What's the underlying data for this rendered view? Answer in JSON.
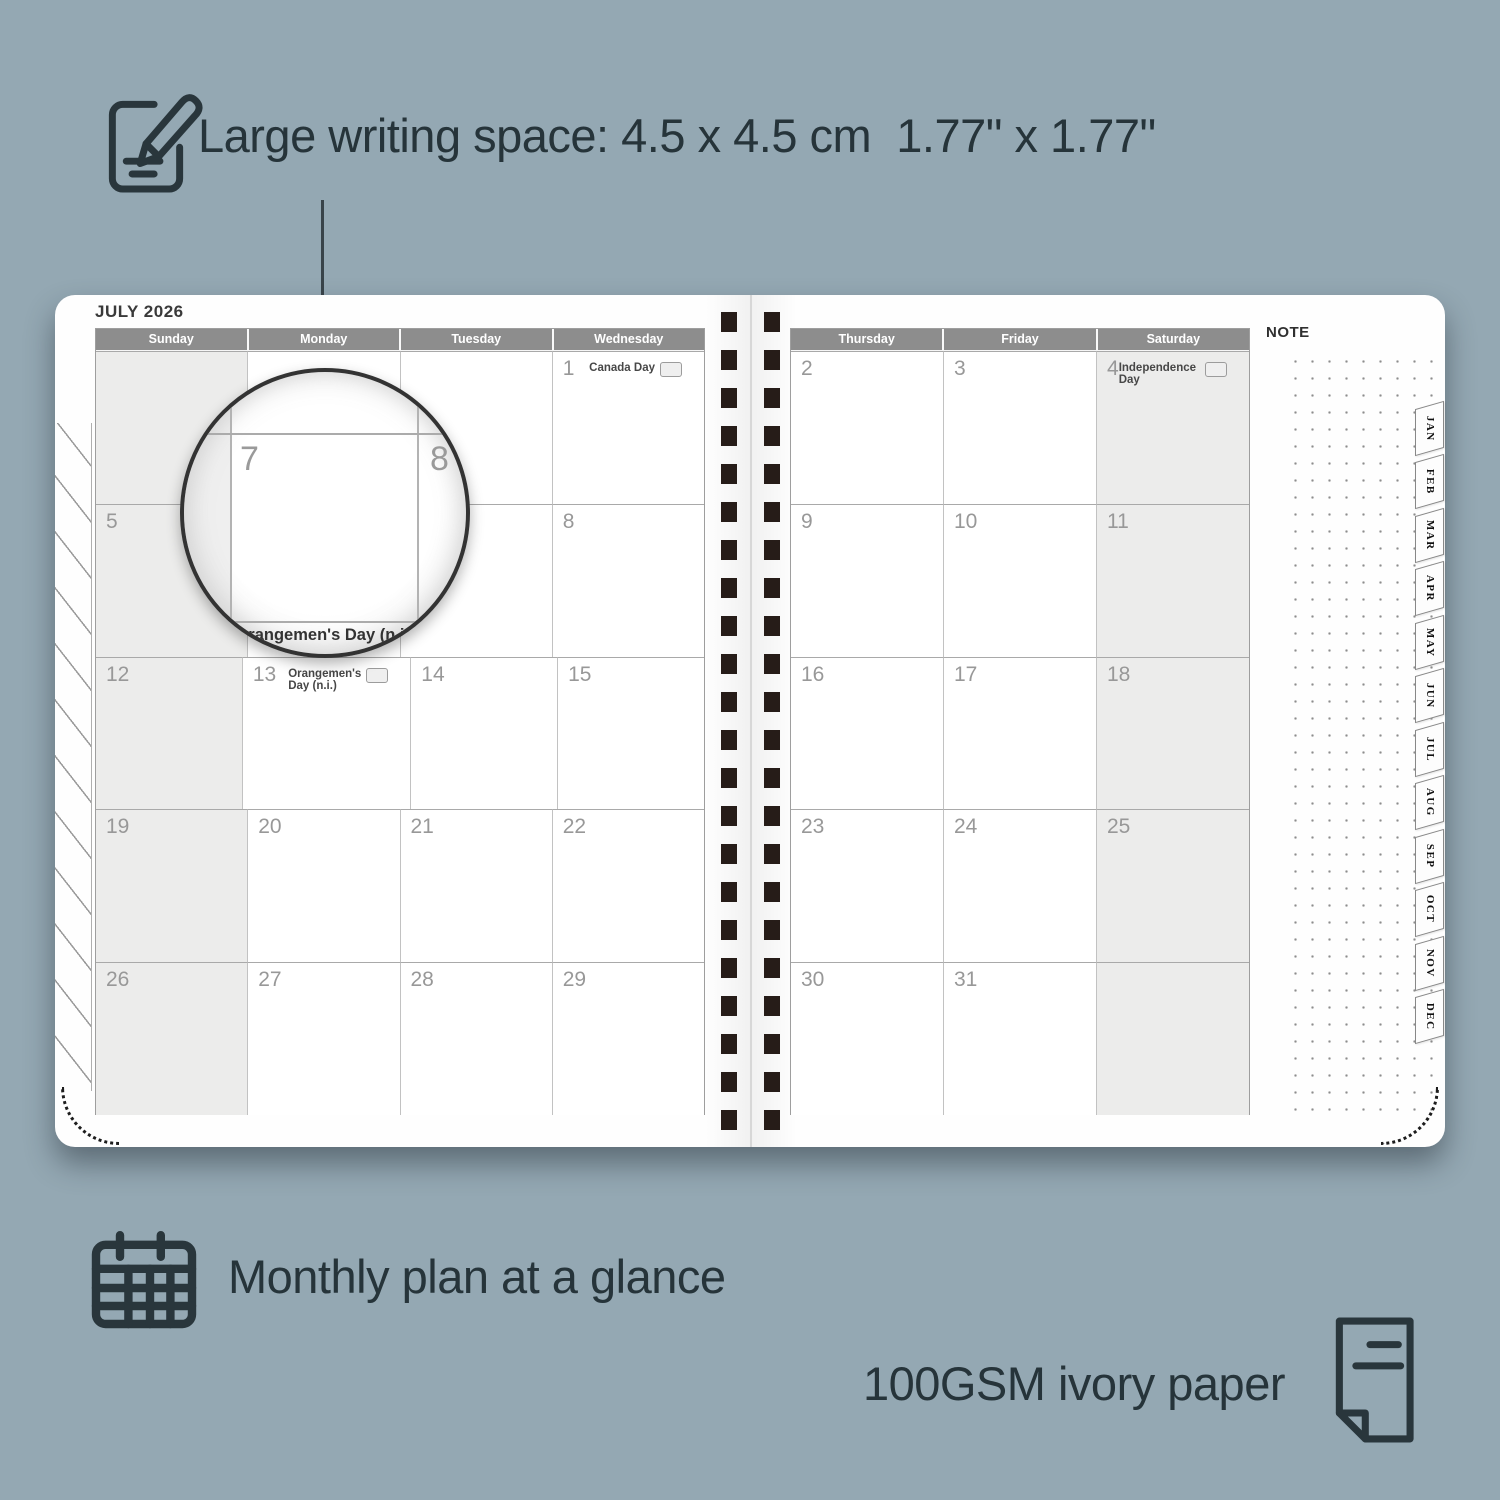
{
  "colors": {
    "background": "#94a8b3",
    "header_gray": "#8d8d8d",
    "shaded_cell": "#ececeb",
    "binding_dark": "#261c18",
    "accent_text": "#26343a"
  },
  "features": {
    "writing_space": {
      "label": "Large writing space: 4.5 x 4.5 cm  1.77\" x 1.77\""
    },
    "monthly": {
      "label": "Monthly plan at a glance"
    },
    "paper": {
      "label": "100GSM ivory paper"
    }
  },
  "planner": {
    "month_title": "JULY 2026",
    "note_label": "NOTE",
    "left_calendar": {
      "headers": [
        "Sunday",
        "Monday",
        "Tuesday",
        "Wednesday"
      ],
      "rows": [
        [
          {
            "day": ""
          },
          {
            "day": ""
          },
          {
            "day": ""
          },
          {
            "day": "1",
            "holiday": "Canada Day"
          }
        ],
        [
          {
            "day": "5"
          },
          {
            "day": "6"
          },
          {
            "day": "7"
          },
          {
            "day": "8"
          }
        ],
        [
          {
            "day": "12"
          },
          {
            "day": "13",
            "holiday": "Orangemen's Day (n.i.)"
          },
          {
            "day": "14"
          },
          {
            "day": "15"
          }
        ],
        [
          {
            "day": "19"
          },
          {
            "day": "20"
          },
          {
            "day": "21"
          },
          {
            "day": "22"
          }
        ],
        [
          {
            "day": "26"
          },
          {
            "day": "27"
          },
          {
            "day": "28"
          },
          {
            "day": "29"
          }
        ]
      ]
    },
    "right_calendar": {
      "headers": [
        "Thursday",
        "Friday",
        "Saturday"
      ],
      "rows": [
        [
          {
            "day": "2"
          },
          {
            "day": "3"
          },
          {
            "day": "4",
            "holiday": "Independence Day"
          }
        ],
        [
          {
            "day": "9"
          },
          {
            "day": "10"
          },
          {
            "day": "11"
          }
        ],
        [
          {
            "day": "16"
          },
          {
            "day": "17"
          },
          {
            "day": "18"
          }
        ],
        [
          {
            "day": "23"
          },
          {
            "day": "24"
          },
          {
            "day": "25"
          }
        ],
        [
          {
            "day": "30"
          },
          {
            "day": "31"
          },
          {
            "day": ""
          }
        ]
      ]
    },
    "tabs": [
      "JAN",
      "FEB",
      "MAR",
      "APR",
      "MAY",
      "JUN",
      "JUL",
      "AUG",
      "SEP",
      "OCT",
      "NOV",
      "DEC"
    ],
    "magnifier": {
      "day_left": "7",
      "day_right": "8",
      "holiday": "Orangemen's Day (n.i.)"
    }
  }
}
